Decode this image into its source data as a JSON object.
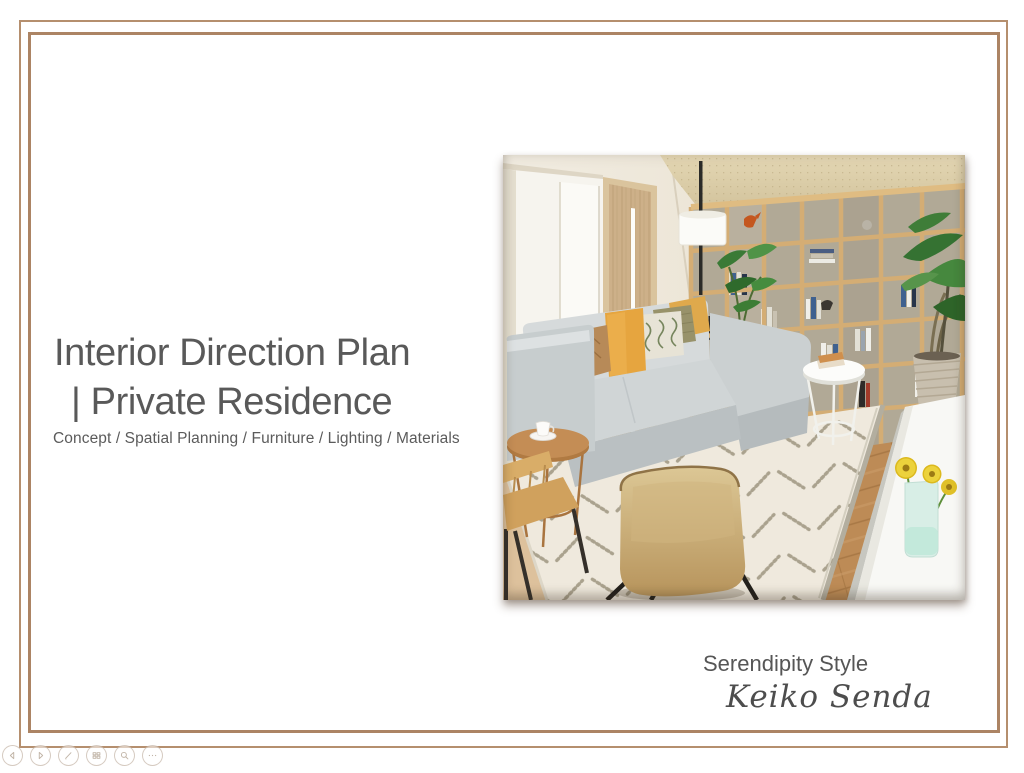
{
  "slide": {
    "title_line1": "Interior Direction Plan",
    "title_line2": "| Private Residence",
    "subtitle": "Concept / Spatial Planning / Furniture / Lighting / Materials",
    "credit": {
      "studio": "Serendipity Style",
      "author": "Keiko Senda"
    }
  },
  "colors": {
    "frame": "#b08a68",
    "title_text": "#595959",
    "slide_background": "#ffffff",
    "accent_mustard": "#e6a53f",
    "accent_wood": "#d4ad74"
  },
  "hero_image": {
    "scene_elements": [
      "wardrobe",
      "wood-door",
      "accent-wall",
      "bookshelf",
      "books",
      "floor-lamp",
      "indoor-plant",
      "wood-floor",
      "white-console",
      "flower-vase",
      "planter-pot",
      "area-rug",
      "corner-sofa",
      "throw-pillows",
      "wire-side-table",
      "wood-side-table",
      "coffee-cup",
      "wood-chair",
      "tan-chair"
    ]
  },
  "presenter_controls": {
    "items": [
      {
        "name": "previous-slide",
        "icon": "chevron-left-icon"
      },
      {
        "name": "next-slide",
        "icon": "chevron-right-icon"
      },
      {
        "name": "annotate-pen",
        "icon": "pen-icon"
      },
      {
        "name": "all-slides",
        "icon": "grid-icon"
      },
      {
        "name": "zoom-slide",
        "icon": "magnifier-icon"
      },
      {
        "name": "more-options",
        "icon": "ellipsis-icon"
      }
    ]
  }
}
